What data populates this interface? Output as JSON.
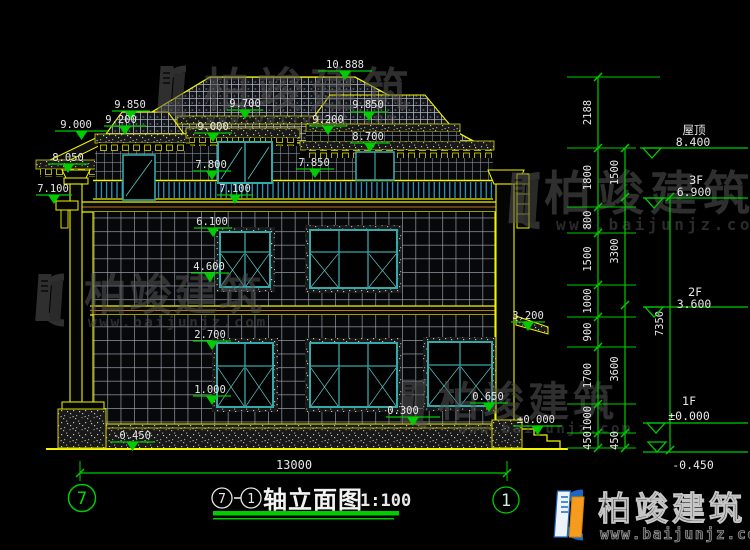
{
  "drawing_title": {
    "axis_from": "7",
    "axis_to": "1",
    "name": "轴立面图",
    "scale": "1:100"
  },
  "axis_bubbles": {
    "left": "7",
    "right": "1"
  },
  "overall_width_dim": "13000",
  "elevation_markers": [
    {
      "id": "ridge",
      "value": "10.888"
    },
    {
      "id": "left-dormer-top",
      "value": "9.850"
    },
    {
      "id": "left-dormer-eave",
      "value": "9.200"
    },
    {
      "id": "left-eave",
      "value": "9.000"
    },
    {
      "id": "center-porch-ridge",
      "value": "9.700"
    },
    {
      "id": "center-eave",
      "value": "9.000"
    },
    {
      "id": "right-dormer-top",
      "value": "9.850"
    },
    {
      "id": "right-dormer-eave",
      "value": "9.200"
    },
    {
      "id": "right-eave",
      "value": "8.700"
    },
    {
      "id": "left-cornice",
      "value": "8.050"
    },
    {
      "id": "center-window-top",
      "value": "7.800"
    },
    {
      "id": "right-window-top",
      "value": "7.850"
    },
    {
      "id": "left-balcony",
      "value": "7.100"
    },
    {
      "id": "center-balcony",
      "value": "7.100"
    },
    {
      "id": "2f-window-top",
      "value": "6.100"
    },
    {
      "id": "2f-window-sill",
      "value": "4.600"
    },
    {
      "id": "1f-window-top",
      "value": "2.700"
    },
    {
      "id": "1f-window-sill",
      "value": "1.000"
    },
    {
      "id": "canopy",
      "value": "3.200"
    },
    {
      "id": "plinth-top",
      "value": "0.300"
    },
    {
      "id": "right-pedestal",
      "value": "0.650"
    },
    {
      "id": "entry-landing",
      "value": "±0.000"
    },
    {
      "id": "ground",
      "value": "-0.450"
    }
  ],
  "level_labels": [
    {
      "name": "屋顶",
      "value": "8.400"
    },
    {
      "name": "3F",
      "value": "6.900"
    },
    {
      "name": "2F",
      "value": "3.600"
    },
    {
      "name": "1F",
      "value": "±0.000"
    },
    {
      "name": "",
      "value": "-0.450"
    }
  ],
  "dimension_chains": {
    "inner": [
      "2188",
      "1800",
      "800",
      "1500",
      "1000",
      "900",
      "1700",
      "1000",
      "450"
    ],
    "middle": [
      "1500",
      "3300",
      "3600",
      "450"
    ],
    "outer": [
      "7350"
    ]
  },
  "watermark": {
    "name": "柏竣建筑",
    "url": "www.baijunjz.com"
  },
  "brand": {
    "name": "柏竣建筑",
    "url": "www.baijunjz.com"
  },
  "colors": {
    "line_yellow": "#f5f500",
    "dim_green": "#00cc00",
    "glass_teal": "#35a8a8",
    "railing_cyan": "#35b0e0",
    "text_white": "#e8e8e8",
    "brand_blue": "#1a68c4",
    "brand_orange": "#f59b1e"
  }
}
